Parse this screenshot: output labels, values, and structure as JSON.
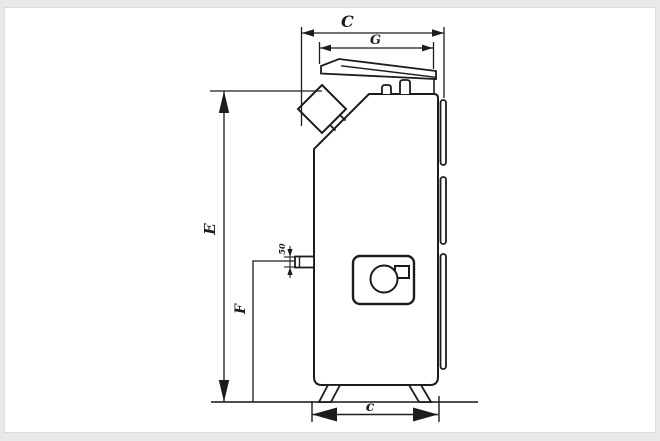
{
  "drawing": {
    "type": "technical-side-view",
    "subject": "solid-fuel-boiler",
    "colors": {
      "line": "#1c1c1c",
      "ground_line": "#4f4f4f",
      "background": "#ffffff",
      "frame": "#e9e9e9"
    },
    "dimensions": {
      "total_width_top": {
        "label": "C"
      },
      "upper_width": {
        "label": "G"
      },
      "total_height": {
        "label": "E"
      },
      "stub_height": {
        "label": "F"
      },
      "stub_offset": {
        "label": "50"
      },
      "base_depth": {
        "label": "c"
      }
    },
    "parts": [
      "flue-outlet",
      "boiler-body",
      "top-lid",
      "lid-hinges",
      "door-panel",
      "burner-opening",
      "door-latch",
      "return-stub",
      "support-feet",
      "hinge-strips",
      "ground-line"
    ]
  }
}
